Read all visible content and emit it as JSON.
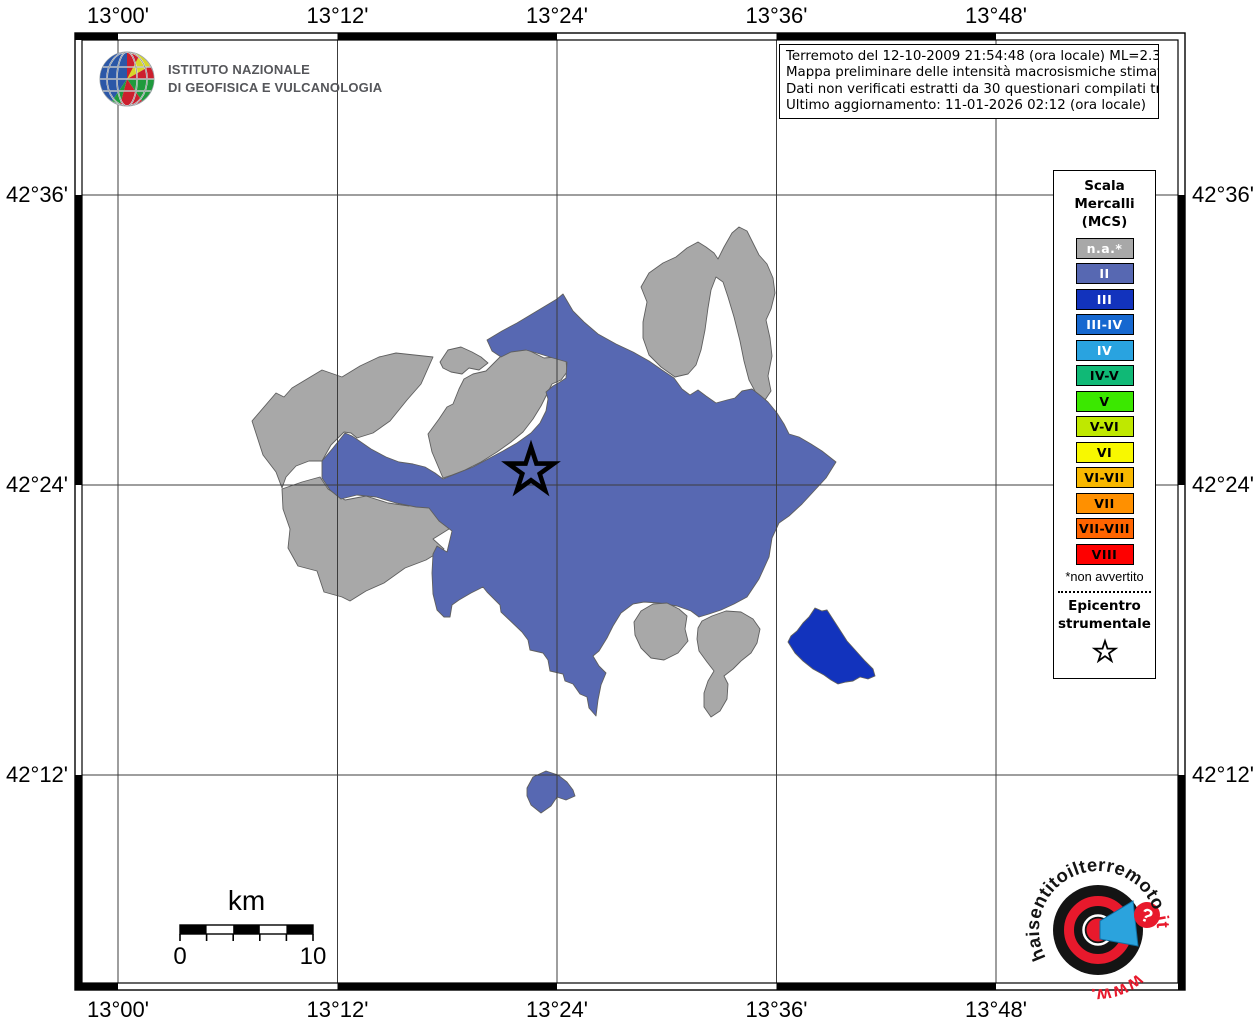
{
  "ingv_logo": {
    "line1": "ISTITUTO NAZIONALE",
    "line2": "DI GEOFISICA E VULCANOLOGIA"
  },
  "info_box": {
    "lines": [
      "Terremoto del 12-10-2009 21:54:48 (ora locale) ML=2.3 Prof=10 km",
      "Mappa preliminare delle intensità macrosismiche stimate nei comuni",
      "Dati non verificati estratti da 30 questionari compilati tramite Internet.",
      "Ultimo aggiornamento: 11-01-2026 02:12 (ora locale)"
    ]
  },
  "axes": {
    "top": [
      "13°00'",
      "13°12'",
      "13°24'",
      "13°36'",
      "13°48'"
    ],
    "bottom": [
      "13°00'",
      "13°12'",
      "13°24'",
      "13°36'",
      "13°48'"
    ],
    "left": [
      "42°36'",
      "42°24'",
      "42°12'"
    ],
    "right": [
      "42°36'",
      "42°24'",
      "42°12'"
    ]
  },
  "legend": {
    "title_lines": [
      "Scala",
      "Mercalli",
      "(MCS)"
    ],
    "items": [
      {
        "label": "n.a.*",
        "color": "#a8a8a8",
        "text": "#ffffff"
      },
      {
        "label": "II",
        "color": "#5768b2",
        "text": "#ffffff"
      },
      {
        "label": "III",
        "color": "#1233bd",
        "text": "#ffffff"
      },
      {
        "label": "III-IV",
        "color": "#1668d0",
        "text": "#ffffff"
      },
      {
        "label": "IV",
        "color": "#29a3e0",
        "text": "#ffffff"
      },
      {
        "label": "IV-V",
        "color": "#10b976",
        "text": "#000000"
      },
      {
        "label": "V",
        "color": "#3be800",
        "text": "#000000"
      },
      {
        "label": "V-VI",
        "color": "#bfe800",
        "text": "#000000"
      },
      {
        "label": "VI",
        "color": "#f8f800",
        "text": "#000000"
      },
      {
        "label": "VI-VII",
        "color": "#f8b800",
        "text": "#000000"
      },
      {
        "label": "VII",
        "color": "#ff9000",
        "text": "#000000"
      },
      {
        "label": "VII-VIII",
        "color": "#ff6400",
        "text": "#000000"
      },
      {
        "label": "VIII",
        "color": "#fe0000",
        "text": "#000000"
      }
    ],
    "footnote": "*non avvertito",
    "epicenter_lines": [
      "Epicentro",
      "strumentale"
    ]
  },
  "scale_bar": {
    "unit": "km",
    "start_label": "0",
    "end_label": "10"
  },
  "watermark": {
    "text_main": "haisentitoilterremoto",
    "text_suffix": ".it",
    "text_www": "www.",
    "question_mark": "?",
    "red": "#e8192c",
    "blue": "#2ba3dd"
  },
  "map": {
    "frame": {
      "x": 75,
      "y": 33,
      "w": 1110,
      "h": 957,
      "band": 7
    },
    "grid": {
      "lon_x": [
        118,
        337.5,
        557,
        776.5,
        996
      ],
      "lat_y": [
        195,
        485,
        775
      ]
    },
    "frame_black_cols": [
      [
        75,
        118
      ],
      [
        337.5,
        557
      ],
      [
        776.5,
        996
      ]
    ],
    "frame_black_rows": [
      [
        195,
        485
      ],
      [
        775,
        990
      ]
    ],
    "epicenter": {
      "x": 531,
      "y": 471
    },
    "colors": {
      "na": "#a8a8a8",
      "II": "#5768b2",
      "III": "#1233bd",
      "border": "#5f5f5f"
    },
    "regions": [
      {
        "name": "na-west-upper",
        "intensity": "n.a.",
        "fill": "na",
        "path": "M252,421 L276,393 L284,397 L292,388 L322,370 L342,377 L360,366 L379,357 L396,353 L433,357 L421,384 L407,400 L390,421 L373,433 L357,438 L351,433 L344,432 L331,445 L322,461 L309,461 L296,466 L286,477 L282,488 L276,472 L263,455 Z"
      },
      {
        "name": "na-west-lower",
        "intensity": "n.a.",
        "fill": "na",
        "path": "M282,489 L302,482 L320,477 L328,489 L345,500 L366,496 L388,503 L409,506 L421,500 L428,499 L437,516 L449,529 L433,539 L444,549 L426,560 L405,568 L384,583 L366,591 L350,601 L342,597 L324,592 L317,571 L298,566 L288,548 L290,529 L283,509 Z"
      },
      {
        "name": "na-strip",
        "intensity": "n.a.",
        "fill": "na",
        "path": "M443,478 L432,452 L428,434 L439,419 L447,407 L453,404 L459,389 L464,379 L473,374 L486,371 L493,364 L501,356 L511,351 L526,349 L536,354 L544,358 L556,357 L566,360 L567,372 L561,380 L552,384 L548,392 L541,406 L533,419 L523,432 L511,442 L497,452 L481,462 L465,470 L452,475 Z"
      },
      {
        "name": "na-small-piece",
        "intensity": "n.a.",
        "fill": "na",
        "path": "M440,362 L448,350 L461,347 L472,352 L481,357 L488,363 L479,370 L469,368 L462,374 L451,372 L443,368 Z"
      },
      {
        "name": "na-hook-north",
        "intensity": "n.a.",
        "fill": "na",
        "path": "M675,377 L661,367 L649,355 L643,338 L643,322 L647,302 L641,287 L649,273 L663,263 L676,257 L687,248 L698,242 L706,247 L714,253 L718,259 L724,247 L732,233 L739,227 L747,231 L753,243 L759,255 L767,264 L773,278 L775,293 L771,309 L766,320 L770,338 L772,356 L768,376 L771,391 L765,400 L756,393 L749,380 L744,361 L740,341 L734,317 L728,297 L723,282 L716,277 L711,290 L708,308 L705,330 L701,350 L696,365 L688,374 Z"
      },
      {
        "name": "intensity-II-main",
        "intensity": "II",
        "fill": "II",
        "path": "M322,461 L333,448 L345,433 L352,436 L358,440 L371,449 L386,457 L399,462 L413,464 L425,467 L435,473 L443,479 L458,473 L473,467 L488,459 L503,451 L517,443 L531,433 L540,423 L546,411 L548,399 L546,392 L553,386 L560,382 L566,378 L567,362 L553,358 L540,354 L526,350 L511,352 L501,357 L492,351 L487,340 L502,331 L517,323 L532,314 L547,305 L557,299 L563,294 L573,311 L584,322 L598,334 L616,344 L633,352 L649,361 L662,370 L674,378 L682,389 L690,395 L698,390 L706,396 L716,403 L727,400 L735,398 L742,391 L752,389 L761,396 L768,402 L777,413 L784,424 L789,434 L799,437 L811,444 L822,451 L836,462 L826,478 L814,491 L802,504 L789,516 L779,523 L772,538 L769,557 L759,579 L747,597 L734,604 L721,610 L709,614 L699,617 L691,611 L677,606 L659,603 L644,602 L633,604 L621,613 L613,626 L607,638 L599,651 L593,656 L599,666 L606,673 L601,685 L598,700 L596,716 L589,708 L587,697 L580,694 L573,684 L565,681 L563,674 L550,671 L548,660 L543,653 L530,650 L528,640 L522,632 L501,612 L500,605 L487,592 L483,587 L471,593 L459,600 L452,605 L450,617 L444,617 L437,610 L433,594 L432,573 L433,554 L437,546 L447,552 L452,531 L439,521 L429,508 L416,507 L396,503 L376,497 L357,495 L341,499 L330,490 L322,478 Z"
      },
      {
        "name": "intensity-II-south-blob",
        "intensity": "II",
        "fill": "II",
        "path": "M527,788 L533,777 L546,771 L558,775 L567,782 L573,790 L575,796 L566,800 L557,797 L551,806 L541,813 L531,805 L527,796 Z"
      },
      {
        "name": "na-south-blob-1",
        "intensity": "n.a.",
        "fill": "na",
        "path": "M634,622 L641,611 L653,604 L667,603 L679,609 L687,616 L685,629 L688,641 L678,653 L664,660 L651,658 L641,648 L635,635 Z"
      },
      {
        "name": "na-south-blob-2",
        "intensity": "n.a.",
        "fill": "na",
        "path": "M702,621 L712,616 L726,611 L741,612 L753,619 L760,629 L757,643 L751,653 L741,661 L733,669 L724,676 L728,684 L727,699 L720,711 L711,717 L704,707 L704,693 L708,681 L714,671 L707,662 L699,651 L697,639 L698,628 Z"
      },
      {
        "name": "intensity-III-east",
        "intensity": "III",
        "fill": "III",
        "path": "M788,642 L791,636 L797,631 L803,623 L809,617 L815,608 L822,611 L827,610 L838,627 L847,641 L856,651 L865,661 L873,669 L875,676 L868,679 L860,677 L853,681 L846,682 L838,684 L831,680 L824,675 L813,669 L803,661 L795,653 Z"
      }
    ]
  }
}
